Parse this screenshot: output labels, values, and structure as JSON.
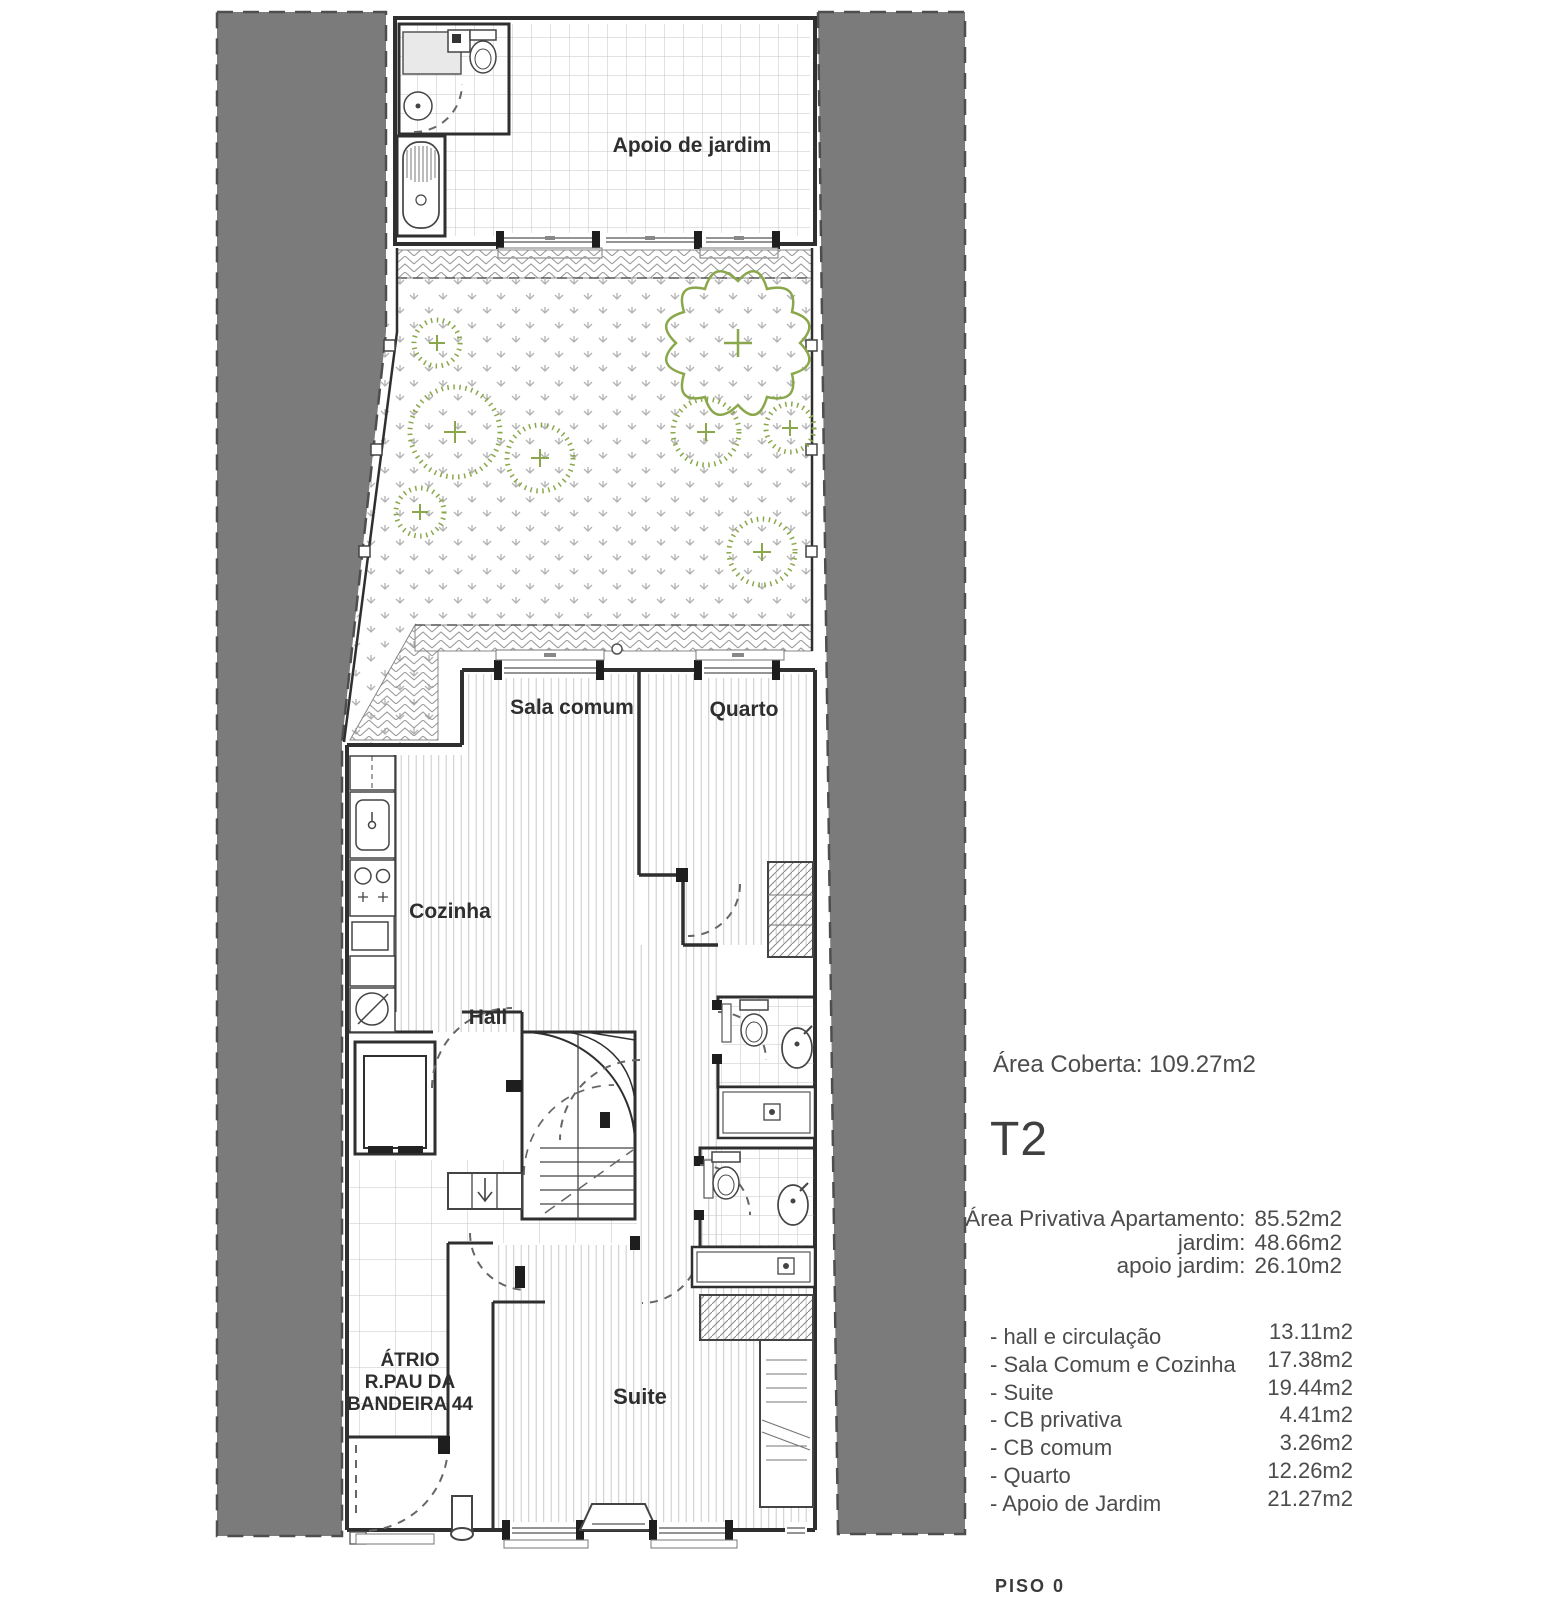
{
  "plan_labels": {
    "apoio": "Apoio de jardim",
    "sala": "Sala comum",
    "quarto": "Quarto",
    "cozinha": "Cozinha",
    "hall": "Hall",
    "atrio_line1": "ÁTRIO",
    "atrio_line2": "R.PAU DA",
    "atrio_line3": "BANDEIRA 44",
    "suite": "Suite"
  },
  "summary": {
    "area_coberta": "Área Coberta: 109.27m2",
    "unit_type": "T2",
    "private_areas": [
      {
        "label": "Área Privativa Apartamento:",
        "value": "85.52m2"
      },
      {
        "label": "jardim:",
        "value": "48.66m2"
      },
      {
        "label": "apoio jardim:",
        "value": "26.10m2"
      }
    ],
    "room_areas": [
      {
        "label": "- hall e circulação",
        "value": "13.11m2"
      },
      {
        "label": "- Sala Comum e Cozinha",
        "value": "17.38m2"
      },
      {
        "label": "- Suite",
        "value": "19.44m2"
      },
      {
        "label": "- CB privativa",
        "value": "4.41m2"
      },
      {
        "label": "- CB comum",
        "value": "3.26m2"
      },
      {
        "label": "- Quarto",
        "value": "12.26m2"
      },
      {
        "label": "- Apoio de Jardim",
        "value": "21.27m2"
      }
    ],
    "floor_label": "PISO 0"
  },
  "colors": {
    "site_gray": "#7b7b7b",
    "wall": "#2f2f2f",
    "vegetation_green": "#8aa84b",
    "text_gray": "#4a4a4a"
  }
}
